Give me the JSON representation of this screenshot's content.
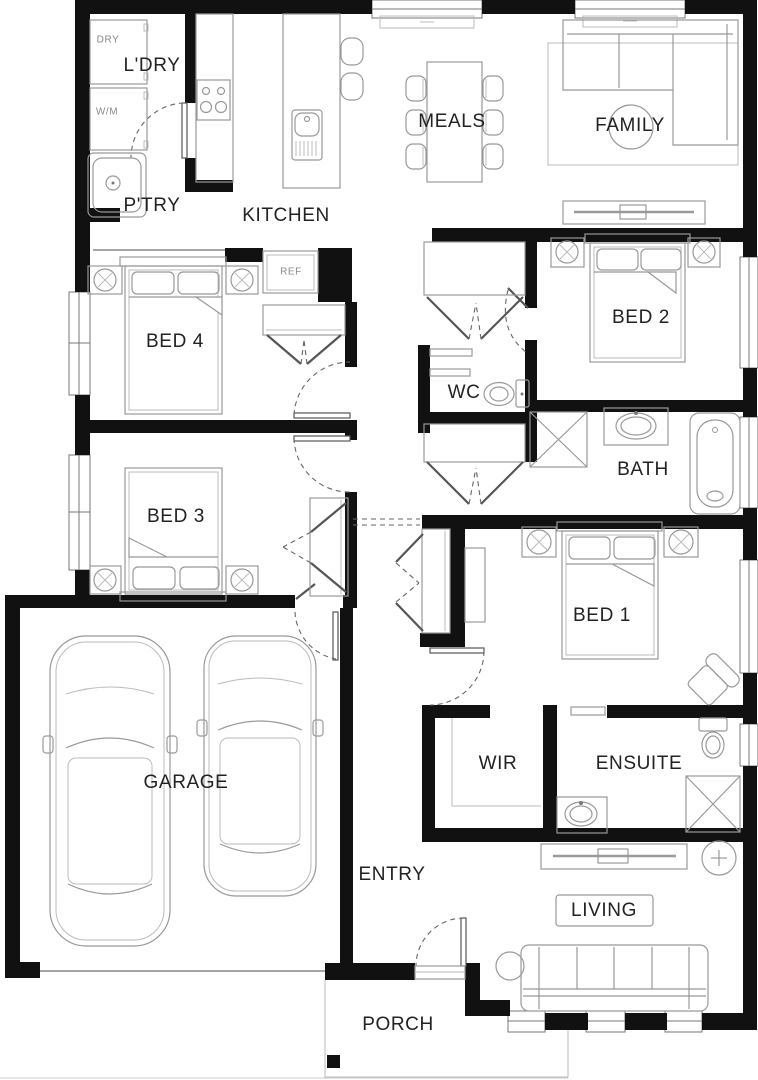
{
  "rooms": {
    "laundry": "L'DRY",
    "pantry": "P'TRY",
    "kitchen": "KITCHEN",
    "meals": "MEALS",
    "family": "FAMILY",
    "bed4": "BED 4",
    "bed2": "BED 2",
    "wc": "WC",
    "bath": "BATH",
    "bed3": "BED 3",
    "bed1": "BED 1",
    "garage": "GARAGE",
    "wir": "WIR",
    "ensuite": "ENSUITE",
    "entry": "ENTRY",
    "living": "LIVING",
    "porch": "PORCH"
  },
  "appliances": {
    "dryer": "DRY",
    "washer": "W/M",
    "fridge": "REF"
  },
  "colors": {
    "background": "#ffffff",
    "wall": "#111111",
    "furniture_line": "#999999",
    "label": "#222222",
    "dashed": "#666666"
  }
}
